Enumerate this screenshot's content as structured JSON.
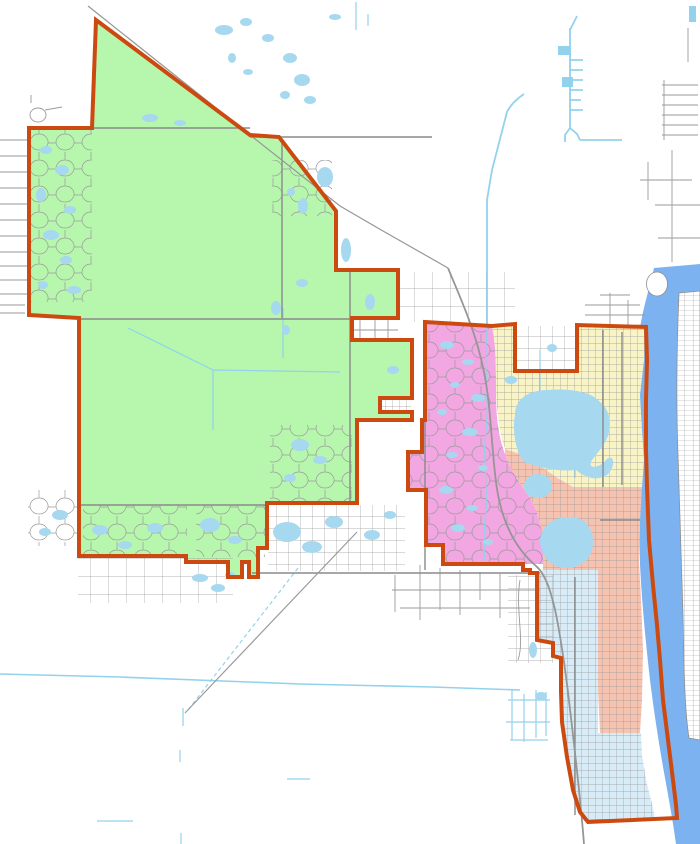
{
  "map": {
    "kind": "municipal-district-boundary-map",
    "colors": {
      "background": "#ffffff",
      "city_boundary": "#cc4a10",
      "district_green": "#b7f7ad",
      "district_pink": "#f2a6e2",
      "district_yellow": "#f8f4c6",
      "district_salmon": "#f6c3b0",
      "district_light_blue": "#d8ecf7",
      "river": "#7db2f0",
      "pond": "#a6d8f0",
      "canal": "#92d2ec",
      "road": "#9a9a9a",
      "road_major": "#8a8a8a",
      "railroad": "#969696",
      "island_fill": "#ffffff",
      "island_outline": "#8f8f8f"
    },
    "districts": [
      {
        "name": "northwest-district",
        "color_key": "district_green"
      },
      {
        "name": "central-district",
        "color_key": "district_pink"
      },
      {
        "name": "northeast-district",
        "color_key": "district_yellow"
      },
      {
        "name": "east-river-district",
        "color_key": "district_salmon"
      },
      {
        "name": "southeast-district",
        "color_key": "district_light_blue"
      }
    ],
    "water_features": [
      {
        "name": "river"
      },
      {
        "name": "north-lake"
      },
      {
        "name": "south-lake"
      },
      {
        "name": "canal-network"
      },
      {
        "name": "ponds"
      }
    ]
  }
}
